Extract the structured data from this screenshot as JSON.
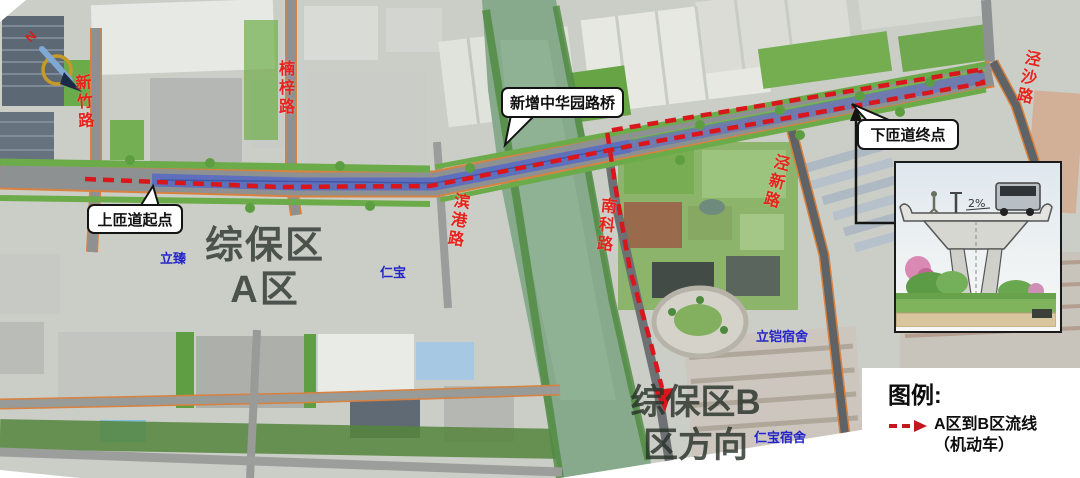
{
  "map": {
    "road_labels": [
      {
        "text": "新竹路"
      },
      {
        "text": "楠梓路"
      },
      {
        "text": "滨港路"
      },
      {
        "text": "南科路"
      },
      {
        "text": "泾新路"
      },
      {
        "text": "泾沙路"
      }
    ],
    "area_labels": [
      {
        "line1": "综保区",
        "line2": "A区"
      },
      {
        "line1": "综保区B",
        "line2": "区方向"
      }
    ],
    "site_labels": [
      {
        "text": "立臻"
      },
      {
        "text": "仁宝"
      },
      {
        "text": "立铠宿舍"
      },
      {
        "text": "仁宝宿舍"
      }
    ],
    "callouts": [
      {
        "text": "上匝道起点"
      },
      {
        "text": "新增中华园路桥"
      },
      {
        "text": "下匝道终点"
      }
    ],
    "compass": {
      "north_label": "N"
    }
  },
  "inset": {
    "slope_label": "2%"
  },
  "legend": {
    "title": "图例:",
    "items": [
      {
        "line1": "A区到B区流线",
        "line2": "（机动车）"
      }
    ]
  },
  "colors": {
    "route_red": "#d8161c",
    "road_label_red": "#e8231c",
    "site_label_blue": "#2424cc",
    "bridge_highlight_blue": "#5668c4"
  }
}
